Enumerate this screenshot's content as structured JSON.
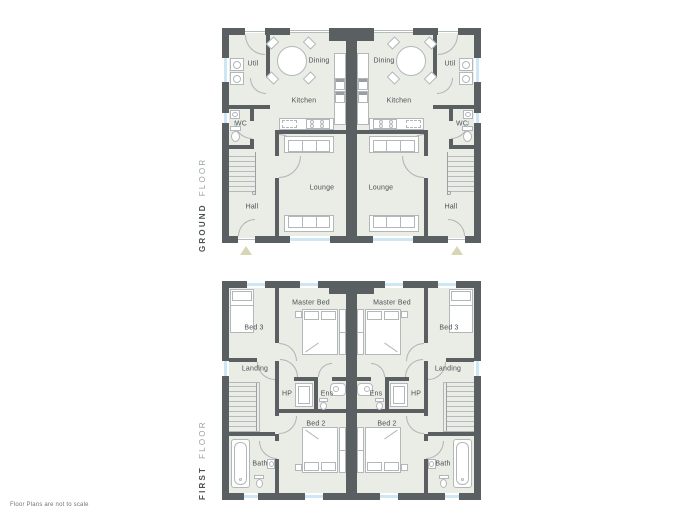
{
  "page": {
    "footnote": "Floor Plans are not to scale"
  },
  "floors": {
    "ground": {
      "title_primary": "GROUND",
      "title_secondary": "FLOOR",
      "rooms": {
        "util": "Util",
        "dining": "Dining",
        "kitchen": "Kitchen",
        "wc": "WC",
        "lounge": "Lounge",
        "hall": "Hall"
      }
    },
    "first": {
      "title_primary": "FIRST",
      "title_secondary": "FLOOR",
      "rooms": {
        "bed3": "Bed 3",
        "master_bed": "Master Bed",
        "landing": "Landing",
        "hp": "HP",
        "ens": "Ens",
        "bed2": "Bed 2",
        "bath": "Bath"
      }
    }
  },
  "colors": {
    "wall": "#5a5f62",
    "floor": "#e9ede5",
    "window": "#cde7f5",
    "furniture_line": "#b2b8ba",
    "entrance_arrow": "#d8d5b4",
    "label_text": "#4b5154",
    "title_secondary_text": "#9aa1a4"
  }
}
